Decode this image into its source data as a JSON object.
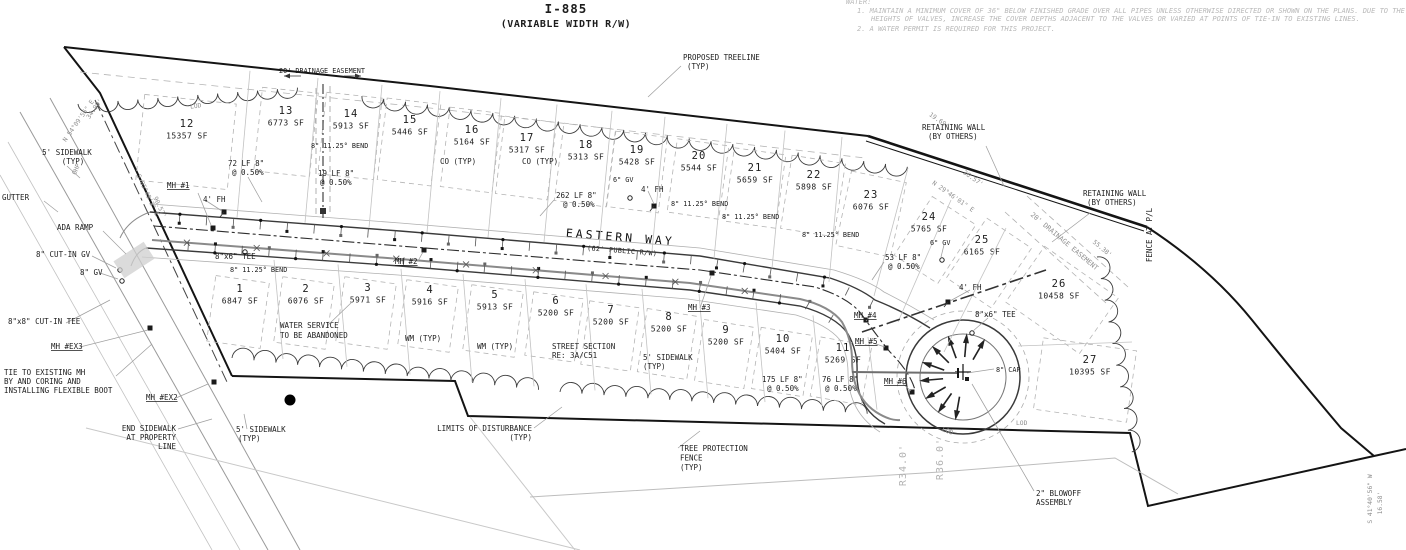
{
  "title": {
    "line1": "I-885",
    "line2": "(VARIABLE WIDTH R/W)"
  },
  "street": {
    "name": "EASTERN WAY",
    "rw": "(62' PUBLIC R/W)"
  },
  "water_notes": {
    "heading": "WATER:",
    "note1a": "1.  MAINTAIN A MINIMUM COVER OF 36\" BELOW FINISHED GRADE OVER ALL PIPES UNLESS OTHERWISE DIRECTED OR SHOWN ON THE PLANS.  DUE TO THE",
    "note1b": "HEIGHTS OF VALVES, INCREASE THE COVER DEPTHS ADJACENT TO THE VALVES OR VARIED AT POINTS OF TIE-IN TO EXISTING LINES.",
    "note2": "2.  A WATER PERMIT IS REQUIRED FOR THIS PROJECT."
  },
  "lots": [
    {
      "number": "1",
      "area": "6847 SF"
    },
    {
      "number": "2",
      "area": "6076 SF"
    },
    {
      "number": "3",
      "area": "5971 SF"
    },
    {
      "number": "4",
      "area": "5916 SF"
    },
    {
      "number": "5",
      "area": "5913 SF"
    },
    {
      "number": "6",
      "area": "5200 SF"
    },
    {
      "number": "7",
      "area": "5200 SF"
    },
    {
      "number": "8",
      "area": "5200 SF"
    },
    {
      "number": "9",
      "area": "5200 SF"
    },
    {
      "number": "10",
      "area": "5404 SF"
    },
    {
      "number": "11",
      "area": "5269 SF"
    },
    {
      "number": "12",
      "area": "15357 SF"
    },
    {
      "number": "13",
      "area": "6773 SF"
    },
    {
      "number": "14",
      "area": "5913 SF"
    },
    {
      "number": "15",
      "area": "5446 SF"
    },
    {
      "number": "16",
      "area": "5164 SF"
    },
    {
      "number": "17",
      "area": "5317 SF"
    },
    {
      "number": "18",
      "area": "5313 SF"
    },
    {
      "number": "19",
      "area": "5428 SF"
    },
    {
      "number": "20",
      "area": "5544 SF"
    },
    {
      "number": "21",
      "area": "5659 SF"
    },
    {
      "number": "22",
      "area": "5898 SF"
    },
    {
      "number": "23",
      "area": "6076 SF"
    },
    {
      "number": "24",
      "area": "5765 SF"
    },
    {
      "number": "25",
      "area": "6165 SF"
    },
    {
      "number": "26",
      "area": "10458 SF"
    },
    {
      "number": "27",
      "area": "10395 SF"
    }
  ],
  "annotations": {
    "proposed_treeline": "PROPOSED TREELINE\n(TYP)",
    "retaining_wall": "RETAINING WALL\n(BY OTHERS)",
    "fence_at_pl": "FENCE AT P/L",
    "drainage_easement": "20' DRAINAGE EASEMENT",
    "sidewalk_typ": "5' SIDEWALK\n(TYP)",
    "gutter": "GUTTER",
    "ada_ramp": "ADA RAMP",
    "cut_in_gv": "8\" CUT-IN GV",
    "gv_8": "8\" GV",
    "cut_in_tee": "8\"x8\" CUT-IN TEE",
    "mh_ex3": "MH #EX3",
    "mh_ex2": "MH #EX2",
    "tie_note": "TIE TO EXISTING MH\nBY AND CORING AND\nINSTALLING FLEXIBLE BOOT",
    "end_sidewalk": "END SIDEWALK\nAT PROPERTY\nLINE",
    "mh1": "MH #1",
    "mh2": "MH #2",
    "mh3": "MH #3",
    "mh4": "MH #4",
    "mh5": "MH #5",
    "mh6": "MH #6",
    "fh": "4' FH",
    "seg72": "72 LF 8\"\n@ 0.50%",
    "seg19": "19 LF 8\"\n@ 0.50%",
    "seg262": "262 LF 8\"\n@ 0.50%",
    "seg53": "53 LF 8\"\n@ 0.50%",
    "seg175": "175 LF 8\"\n@ 0.50%",
    "seg76": "76 LF 8\"\n@ 0.50%",
    "bend": "8\" 11.25° BEND",
    "co_typ": "CO (TYP)",
    "gv_6": "6\" GV",
    "tee_8x6": "8\"x6\" TEE",
    "cap_8": "8\" CAP",
    "water_service": "WATER SERVICE\nTO BE ABANDONED",
    "wm_typ": "WM (TYP)",
    "street_section": "STREET SECTION\nRE: 3A/C51",
    "limits_of_disturbance": "LIMITS OF DISTURBANCE\n(TYP)",
    "tree_protection": "TREE PROTECTION\nFENCE\n(TYP)",
    "blowoff": "2\" BLOWOFF\nASSEMBLY",
    "r34": "R34.0'",
    "r36": "R36.0'",
    "dim_19_69": "19.69'",
    "dim_36_57": "36.57'",
    "dim_55_38": "55.38'",
    "dim_34_98": "34.98'",
    "dim_90_57": "90.57'",
    "dim_16_58": "16.58'",
    "brg_nw": "N 54°09'56\" E",
    "brg_w": "S 05°49'3\" E",
    "brg_wall": "N 29°46'01\" E",
    "brg_se": "S 41°40'56\" W",
    "lod": "LOD",
    "ohp": "OHP"
  }
}
